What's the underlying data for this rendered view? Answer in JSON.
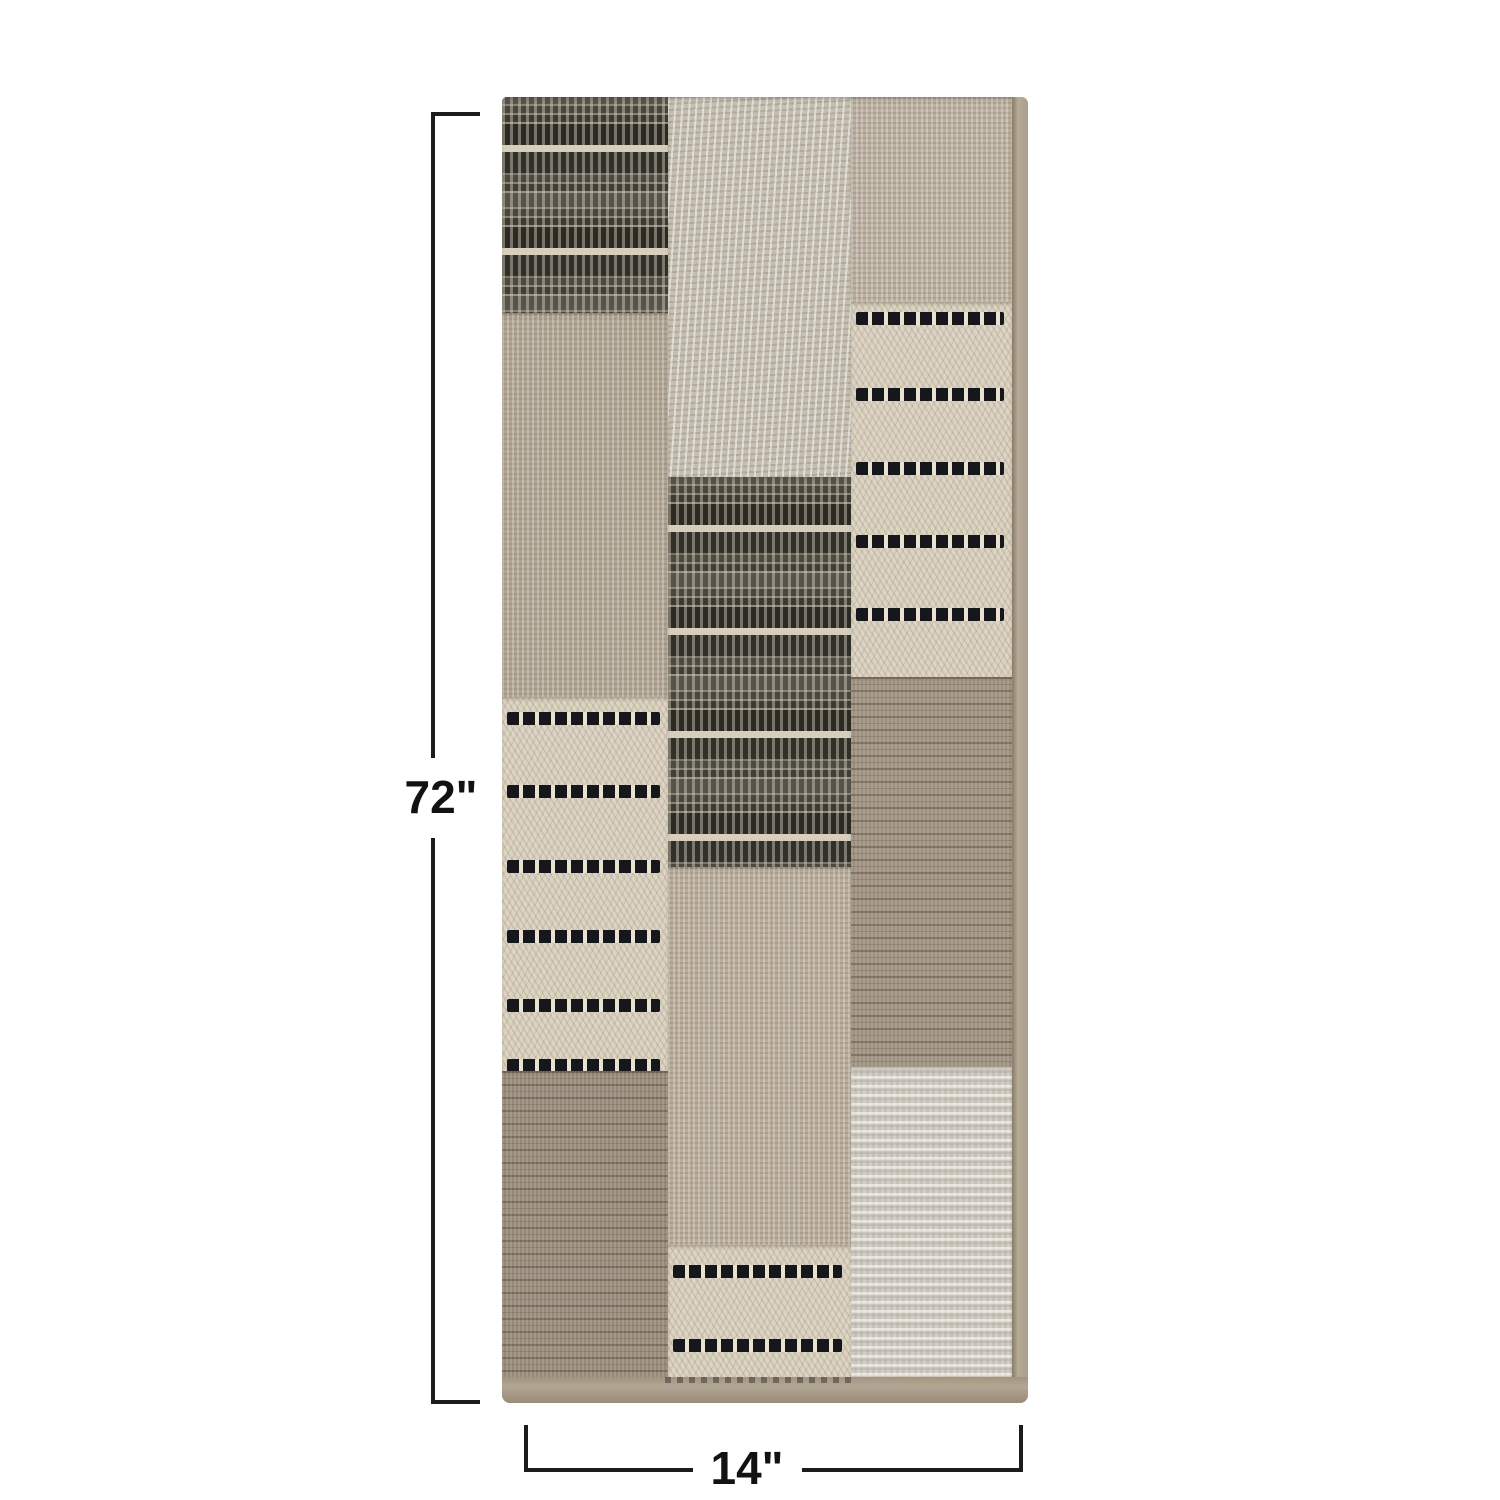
{
  "page": {
    "background_color": "#ffffff",
    "description": "Product photo of a folded patchwork cotton table runner with dimension callouts"
  },
  "annotations": {
    "line_color": "#1c1c1c",
    "height_label": "72\"",
    "width_label": "14\""
  },
  "fabric": {
    "accent_colors": {
      "tan_linen": "#b2a694",
      "cream": "#ddd4c4",
      "charcoal": "#3c3c34",
      "black_dash": "#16161d",
      "taupe_brown": "#9a8c79",
      "gray_heather": "#c5bfb2"
    },
    "panels": [
      {
        "name": "left",
        "width": 166,
        "patches": [
          {
            "type": "dark-stripes",
            "height": 216
          },
          {
            "type": "linen",
            "height": 384,
            "base": "#b0a492"
          },
          {
            "type": "cream-dashes",
            "height": 374,
            "stripes": [
              15,
              88,
              163,
              233,
              302,
              362
            ]
          },
          {
            "type": "brown-stripes",
            "height": 306,
            "base": "#97897a"
          }
        ]
      },
      {
        "name": "center",
        "width": 183,
        "patches": [
          {
            "type": "gray-heather",
            "height": 380,
            "base": "#c5bfb2"
          },
          {
            "type": "dark-stripes",
            "height": 390
          },
          {
            "type": "linen",
            "height": 378,
            "base": "#b8ac9a"
          },
          {
            "type": "cream-dashes",
            "height": 132,
            "stripes": [
              20,
              94
            ]
          }
        ]
      },
      {
        "name": "right",
        "width": 161,
        "patches": [
          {
            "type": "linen",
            "height": 205,
            "base": "#bbafa0"
          },
          {
            "type": "cream-dashes",
            "height": 375,
            "stripes": [
              10,
              86,
              160,
              233,
              306
            ]
          },
          {
            "type": "brown-stripes",
            "height": 390,
            "base": "#9d9080"
          },
          {
            "type": "gray-heather-h",
            "height": 310,
            "base": "#c6c1b7"
          }
        ]
      }
    ]
  }
}
